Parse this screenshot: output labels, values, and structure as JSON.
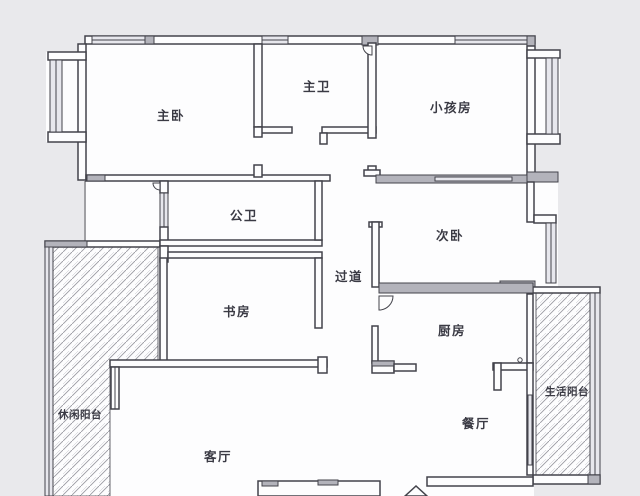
{
  "plan_title": "三室两厅户型图",
  "colors": {
    "background": "#e9e9ec",
    "floor": "#fdfdfe",
    "wall_line": "#43434b",
    "wall_fill": "#b3b3bb",
    "window_fill": "#e7e7ed",
    "hatch": "#9a9aa2",
    "label": "#3a3a44"
  },
  "rooms": [
    {
      "id": "master-bedroom",
      "label": "主卧"
    },
    {
      "id": "master-bathroom",
      "label": "主卫"
    },
    {
      "id": "kids-room",
      "label": "小孩房"
    },
    {
      "id": "public-bathroom",
      "label": "公卫"
    },
    {
      "id": "second-bedroom",
      "label": "次卧"
    },
    {
      "id": "hallway",
      "label": "过道"
    },
    {
      "id": "study",
      "label": "书房"
    },
    {
      "id": "kitchen",
      "label": "厨房"
    },
    {
      "id": "leisure-balcony",
      "label": "休闲阳台"
    },
    {
      "id": "living-room",
      "label": "客厅"
    },
    {
      "id": "dining-room",
      "label": "餐厅"
    },
    {
      "id": "utility-balcony",
      "label": "生活阳台"
    }
  ]
}
